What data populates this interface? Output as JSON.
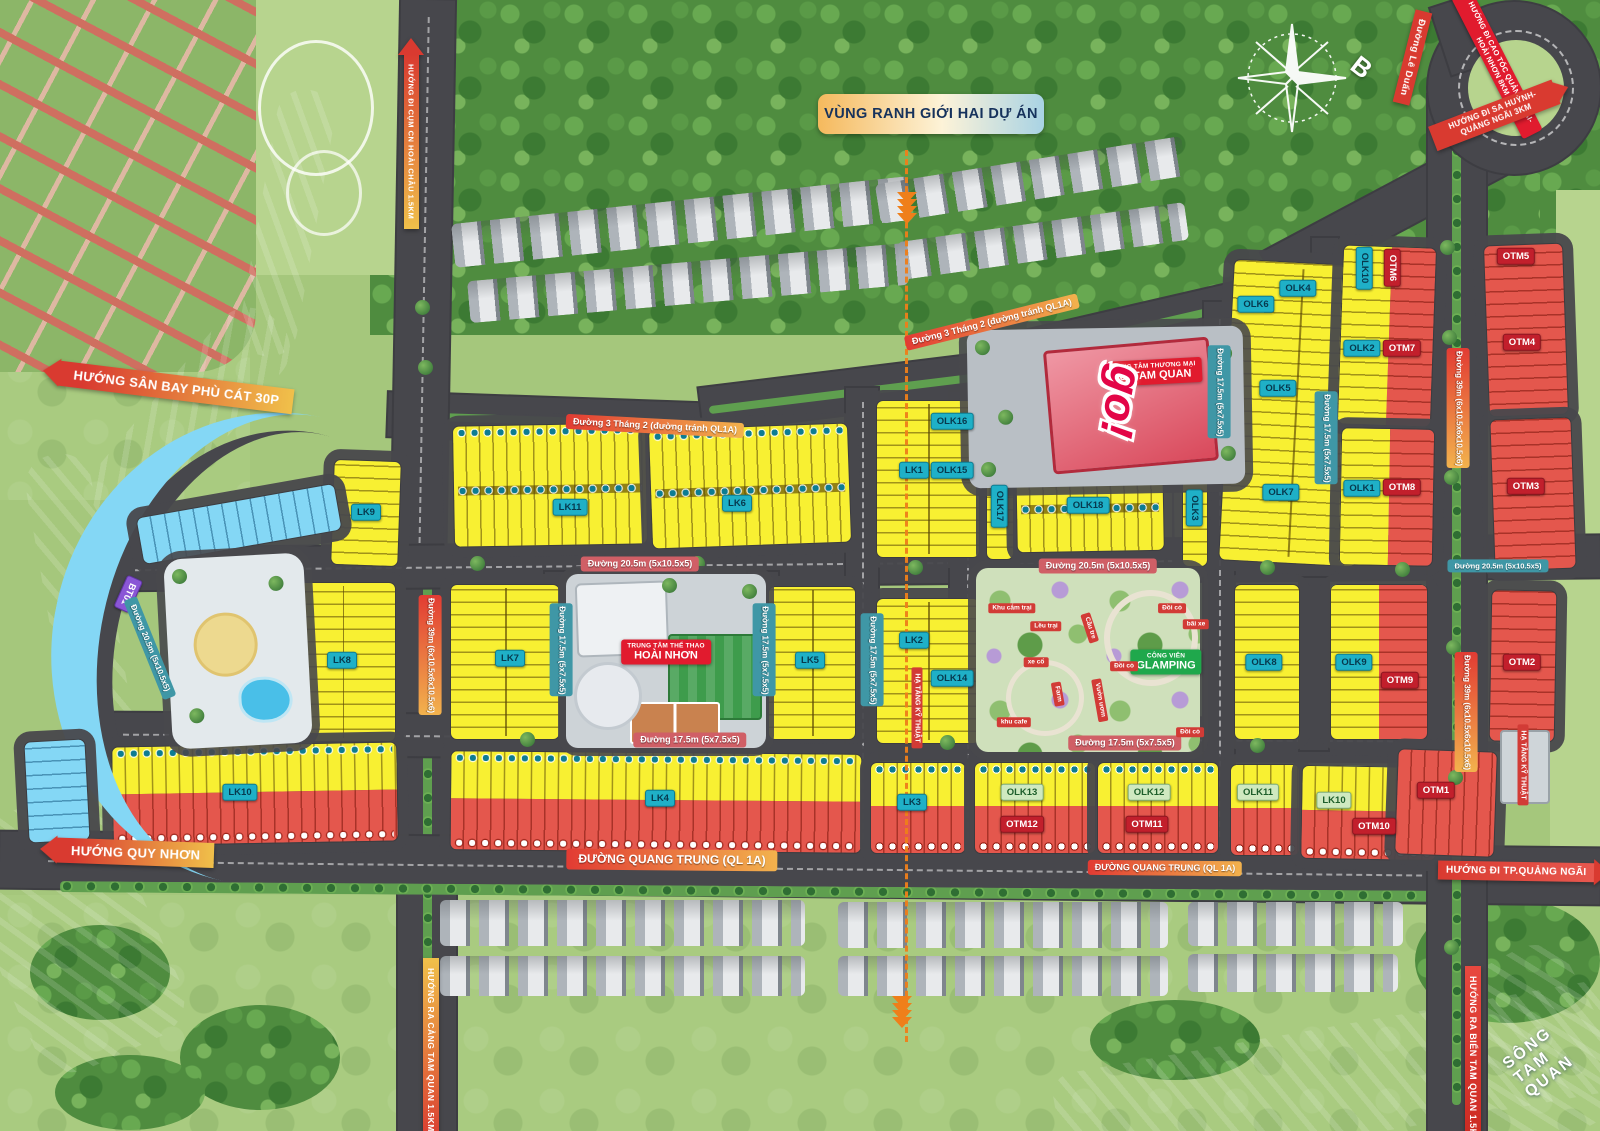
{
  "title": "VÙNG RANH GIỚI HAI DỰ ÁN",
  "compass_north": "B",
  "banners": {
    "airport": "HƯỚNG SÂN BAY PHÙ CÁT 30P",
    "quy_nhon": "HƯỚNG QUY NHƠN",
    "tp_quang_ngai": "HƯỚNG ĐI TP.QUẢNG NGÃI",
    "sea": "HƯỚNG RA BIỂN TAM QUAN 1.5KM",
    "port": "HƯỚNG RA CẢNG TAM QUAN 1.5KM",
    "industrial_cluster": "HƯỚNG ĐI CỤM CN HOÀI CHÂU 1.5KM",
    "le_duan": "Đường Lê Duẩn",
    "expressway": "HƯỚNG ĐI CAO TỐC QUẢNG NGÃI-HOÀI NHƠN 8KM",
    "sa_huynh": "HƯỚNG ĐI SA HUỲNH-QUẢNG NGÃI 3KM"
  },
  "roads": {
    "thang_2": "Đường 3 Tháng 2 (đường tránh QL1A)",
    "d20_5": "Đường 20.5m (5x10.5x5)",
    "d17_5": "Đường 17.5m (5x7.5x5)",
    "d39": "Đường 39m (6x10.5x6x10.5x6)",
    "quang_trung": "ĐƯỜNG QUANG TRUNG (QL 1A)",
    "river": "SÔNG TAM QUAN"
  },
  "blocks": {
    "lk1": "LK1",
    "lk2": "LK2",
    "lk3": "LK3",
    "lk4": "LK4",
    "lk5": "LK5",
    "lk6": "LK6",
    "lk7": "LK7",
    "lk8": "LK8",
    "lk9": "LK9",
    "lk10": "LK10",
    "lk11": "LK11",
    "bt01": "BT01",
    "olk1": "OLK1",
    "olk2": "OLK2",
    "olk3": "OLK3",
    "olk4": "OLK4",
    "olk5": "OLK5",
    "olk6": "OLK6",
    "olk7": "OLK7",
    "olk8": "OLK8",
    "olk9": "OLK9",
    "olk10": "OLK10",
    "olk11": "OLK11",
    "olk12": "OLK12",
    "olk13": "OLK13",
    "olk14": "OLK14",
    "olk15": "OLK15",
    "olk16": "OLK16",
    "olk17": "OLK17",
    "olk18": "OLK18",
    "otm1": "OTM1",
    "otm2": "OTM2",
    "otm3": "OTM3",
    "otm4": "OTM4",
    "otm5": "OTM5",
    "otm6": "OTM6",
    "otm7": "OTM7",
    "otm8": "OTM8",
    "otm9": "OTM9",
    "otm10": "OTM10",
    "otm11": "OTM11",
    "otm12": "OTM12"
  },
  "facilities": {
    "mall_type": "TRUNG TÂM THƯƠNG MẠI",
    "mall_name": "go! TAM QUAN",
    "mall_logo": "go!",
    "sport_type": "TRUNG TÂM THỂ THAO",
    "sport_name": "HOÀI NHƠN",
    "park_type": "CÔNG VIÊN",
    "park_name": "GLAMPING",
    "infra": "HẠ TẦNG KỸ THUẬT"
  },
  "park_features": {
    "camping": "Khu cắm trại",
    "tents": "Lều trại",
    "old_cars": "xe cổ",
    "farm": "Farm",
    "cafe": "khu cafe",
    "bamboo_bridge": "Cầu tre",
    "nursery": "Vườn ươm",
    "grass_hill": "Đồi cỏ",
    "parking": "bãi xe"
  },
  "colors": {
    "lot_yellow": "#f8f032",
    "lot_red": "#e4574d",
    "lot_cyan": "#84d7f5",
    "badge_teal": "#1fb0c7",
    "accent_red": "#d93a30",
    "park_green": "#1fa84c",
    "boundary_orange": "#ef7f1a"
  }
}
